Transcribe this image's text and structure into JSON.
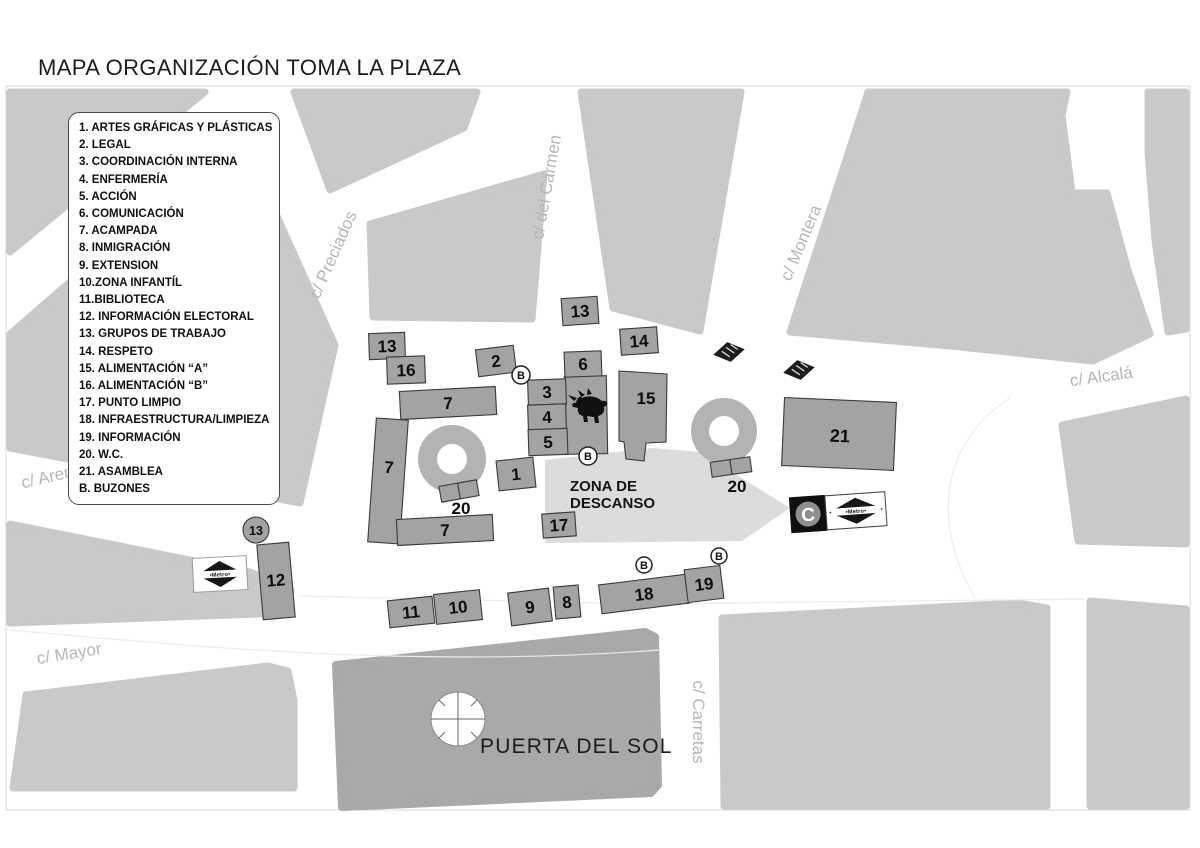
{
  "title": "MAPA ORGANIZACIÓN TOMA LA PLAZA",
  "legend": {
    "items": [
      "1. ARTES GRÁFICAS Y PLÁSTICAS",
      "2. LEGAL",
      "3. COORDINACIÓN INTERNA",
      "4. ENFERMERÍA",
      "5. ACCIÓN",
      "6. COMUNICACIÓN",
      "7. ACAMPADA",
      "8. INMIGRACIÓN",
      "9. EXTENSION",
      "10.ZONA INFANTÍL",
      "11.BIBLIOTECA",
      "12. INFORMACIÓN ELECTORAL",
      "13. GRUPOS DE TRABAJO",
      "14. RESPETO",
      "15. ALIMENTACIÓN “A”",
      "16. ALIMENTACIÓN “B”",
      "17. PUNTO LIMPIO",
      "18. INFRAESTRUCTURA/LIMPIEZA",
      "19. INFORMACIÓN",
      "20. W.C.",
      "21. ASAMBLEA",
      "B. BUZONES"
    ]
  },
  "map": {
    "streets": {
      "preciados": "c/ Preciados",
      "carmen": "c/ del Carmen",
      "montera": "c/ Montera",
      "alcala": "c/ Alcalá",
      "arenal": "c/ Arenal",
      "mayor": "c/ Mayor",
      "carretas": "c/ Carretas"
    },
    "plaza_label": "PUERTA DEL SOL",
    "rest_area": {
      "line1": "ZONA DE",
      "line2": "DESCANSO"
    },
    "buzon_label": "B",
    "metro_label": "•Metro•",
    "cercanias_label": "C",
    "markers": [
      {
        "name": "block-13-carmen",
        "label": "13"
      },
      {
        "name": "block-13-west",
        "label": "13"
      },
      {
        "name": "block-16",
        "label": "16"
      },
      {
        "name": "block-2",
        "label": "2"
      },
      {
        "name": "block-6",
        "label": "6"
      },
      {
        "name": "block-14",
        "label": "14"
      },
      {
        "name": "block-3",
        "label": "3"
      },
      {
        "name": "block-4",
        "label": "4"
      },
      {
        "name": "block-5",
        "label": "5"
      },
      {
        "name": "block-15",
        "label": "15"
      },
      {
        "name": "block-7-north",
        "label": "7"
      },
      {
        "name": "block-7-west",
        "label": "7"
      },
      {
        "name": "block-20-west",
        "label": "20"
      },
      {
        "name": "block-1",
        "label": "1"
      },
      {
        "name": "block-17",
        "label": "17"
      },
      {
        "name": "block-7-south",
        "label": "7"
      },
      {
        "name": "block-20-east",
        "label": "20"
      },
      {
        "name": "block-21",
        "label": "21"
      },
      {
        "name": "badge-13-circle",
        "label": "13"
      },
      {
        "name": "block-12",
        "label": "12"
      },
      {
        "name": "block-11",
        "label": "11"
      },
      {
        "name": "block-10",
        "label": "10"
      },
      {
        "name": "block-9",
        "label": "9"
      },
      {
        "name": "block-8",
        "label": "8"
      },
      {
        "name": "block-18",
        "label": "18"
      },
      {
        "name": "block-19",
        "label": "19"
      }
    ]
  },
  "colors": {
    "building": "#c9c9c9",
    "building_dark": "#a9a9a9",
    "camp_block": "#a3a3a3",
    "camp_block_border": "#3a3a3a",
    "rest_area": "#dcdcdc",
    "street_label": "#b6b6b6",
    "fountain": "#b3b3b3"
  }
}
